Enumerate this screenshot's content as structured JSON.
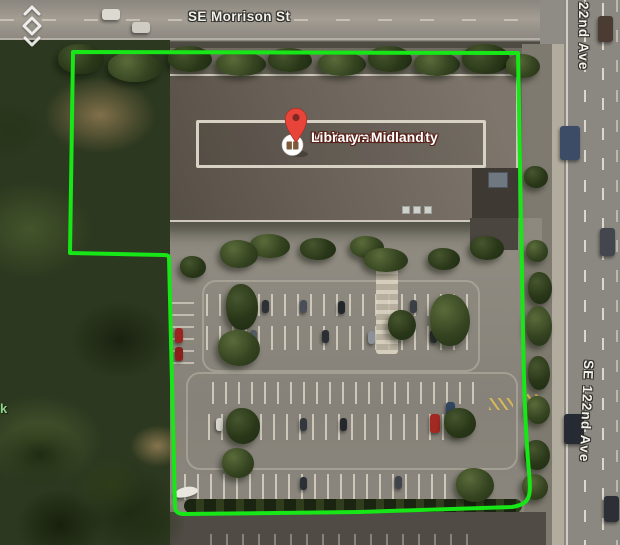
{
  "map": {
    "view": "satellite",
    "poi": {
      "label_line1": "Multnomah County",
      "label_line2": "Library - Midland",
      "pin_color": "#e8443a",
      "pin_dot_color": "#7e2a22",
      "icon_name": "library-book-icon",
      "icon_color": "#7d5b3a",
      "label_text_color": "#ffffff",
      "label_outline_color": "#5a241b"
    },
    "streets": {
      "top": "SE Morrison St",
      "right_top": "22nd Ave",
      "right_side": "SE 122nd Ave"
    },
    "park_label_fragment": "k",
    "park_label_color": "#90d08c",
    "boundary_color": "#17e617",
    "road_icon": "two-way-arrows-diamond"
  }
}
